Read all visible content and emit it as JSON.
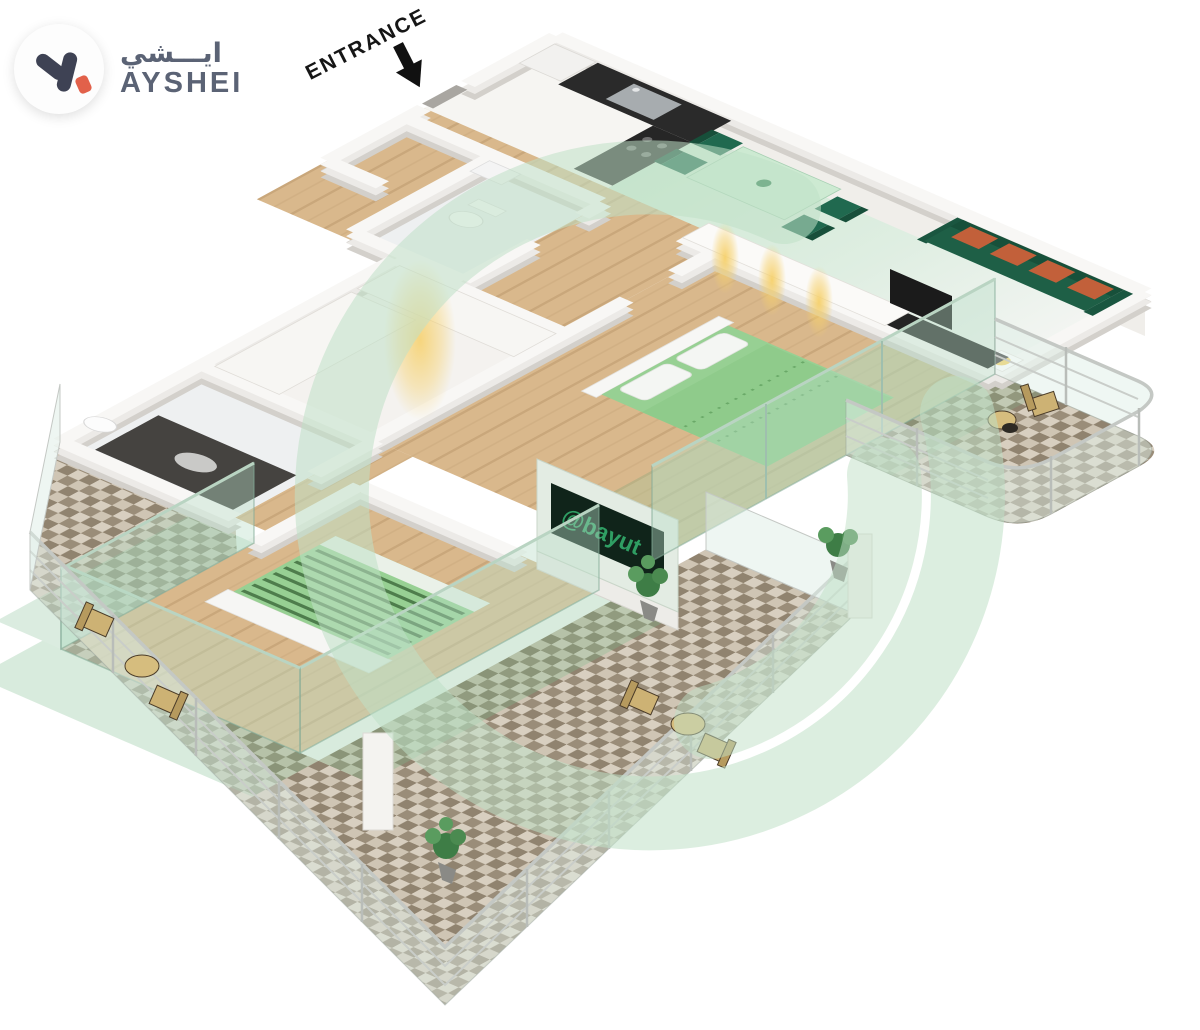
{
  "logo": {
    "arabic": "ايـــشي",
    "name": "AYSHEI"
  },
  "entrance": {
    "label": "ENTRANCE"
  },
  "tv": {
    "watermark": "@bayut"
  },
  "colors": {
    "logo-text": "#5b6375",
    "logo-glyph": "#3e4254",
    "logo-tag": "#e2614a",
    "ring": "#bfe0c6",
    "green-floor": "#cfe9d4",
    "green-dark": "#1e5f46",
    "green-chair": "#20694f",
    "green-table": "#cdead2",
    "green-bed": "#97d093",
    "green-bed-stripe": "#4e7d4c",
    "orange-cushion": "#c2603a",
    "wood": "#d9b88c",
    "tile-a": "#d8cfc0",
    "tile-b": "#90836f",
    "wall-top": "#f8f7f5",
    "wall-mid": "#eceae7",
    "wall-side": "#d3d0cb",
    "counter-dark": "#2a2a2a",
    "steel": "#a7acaf",
    "glass": "#bfe0cf",
    "screen-dark": "#10241a",
    "bayut-green": "#2f9e63",
    "glow": "#f6d06a",
    "tan": "#cdb274"
  }
}
